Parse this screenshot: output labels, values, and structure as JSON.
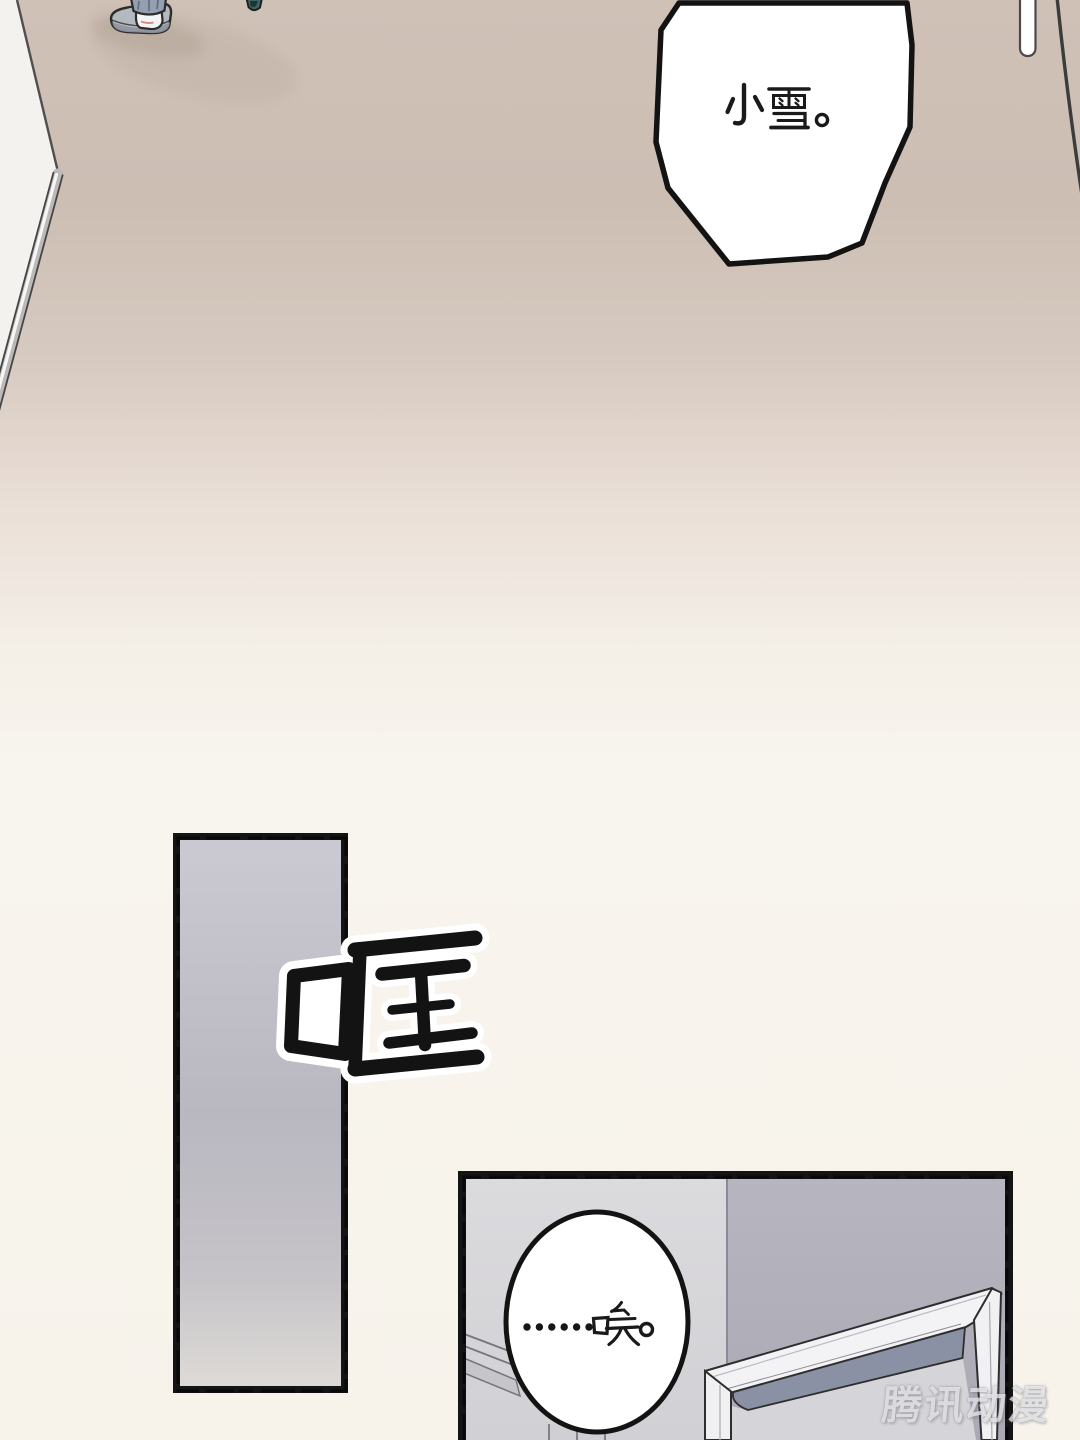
{
  "page": {
    "kind": "comic page",
    "width": 1080,
    "height": 1440
  },
  "dialogue": {
    "bubble_top": {
      "text": "小雪。"
    },
    "bubble_bottom": {
      "text": "……唉。"
    }
  },
  "sfx": {
    "text": "哐"
  },
  "watermark": {
    "text": "腾讯动漫"
  },
  "colors": {
    "floor_beige": "#ccbeb3",
    "paper_cream": "#f8f5ee",
    "panel_gray": "#c0bec7",
    "wall_left": "#d8d7da",
    "wall_right": "#b2b0ba",
    "lintel_shadow": "#8a91a5",
    "door_frame_white": "#f3f3f5",
    "ink": "#141414"
  }
}
